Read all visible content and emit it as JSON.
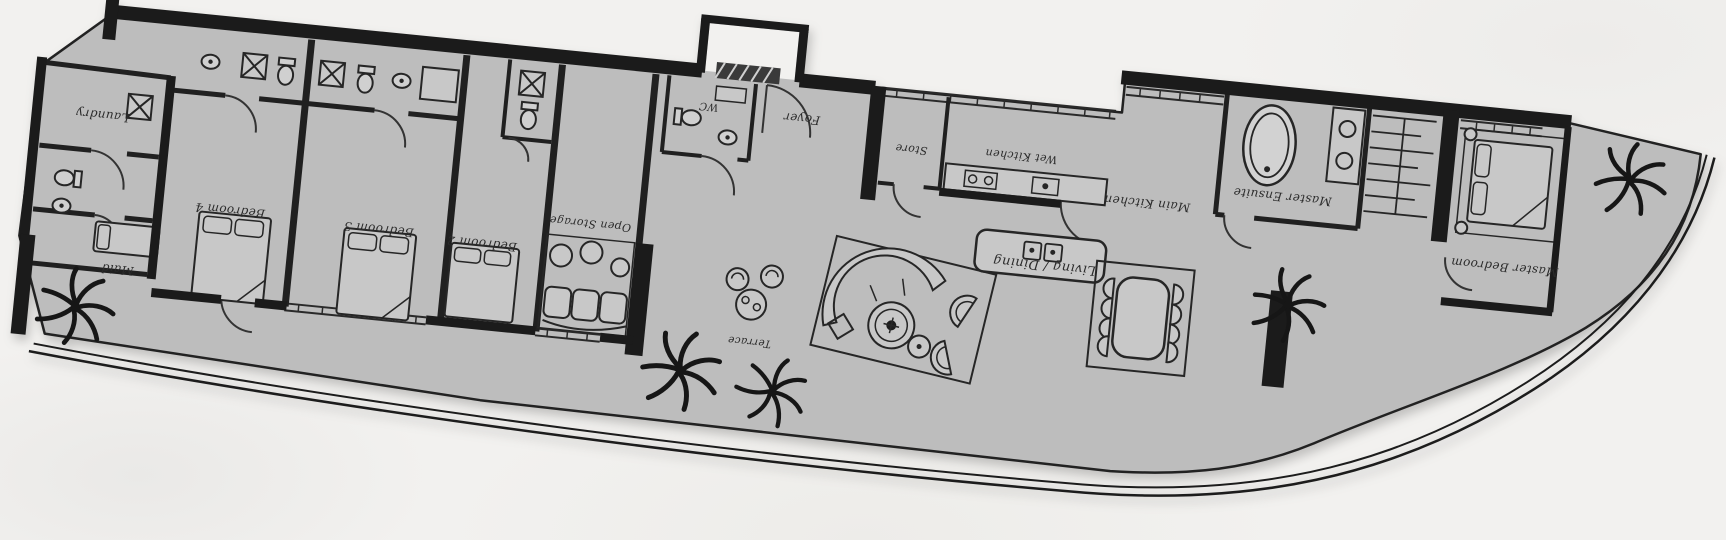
{
  "colors": {
    "paper": "#f2f1ef",
    "floor": "#bdbdbd",
    "wall": "#1b1b1b",
    "furniture": "#c8c8c8",
    "ink": "#2b2b2b"
  },
  "rooms": {
    "laundry": {
      "label": "Laundry"
    },
    "maid": {
      "label": "Maid"
    },
    "bedroom4": {
      "label": "Bedroom 4"
    },
    "bedroom3": {
      "label": "Bedroom 3"
    },
    "bedroom2": {
      "label": "Bedroom 2"
    },
    "open_storage": {
      "label": "Open Storage"
    },
    "wc": {
      "label": "WC"
    },
    "foyer": {
      "label": "Foyer"
    },
    "store": {
      "label": "Store"
    },
    "wet_kitchen": {
      "label": "Wet Kitchen"
    },
    "main_kitchen": {
      "label": "Main Kitchen"
    },
    "living_dining": {
      "label": "Living / Dining"
    },
    "terrace": {
      "label": "Terrace"
    },
    "master_ensuite": {
      "label": "Master Ensuite"
    },
    "master_bedroom": {
      "label": "Master Bedroom"
    }
  }
}
